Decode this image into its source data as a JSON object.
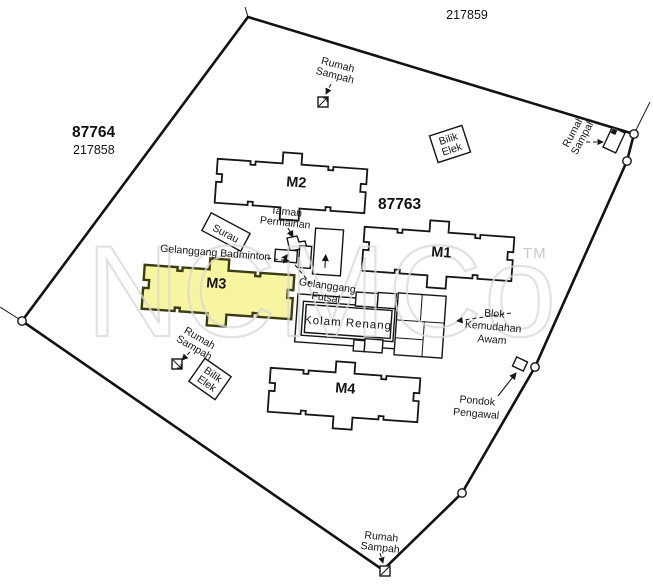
{
  "map": {
    "watermark": {
      "text": "NCMCo",
      "tm": "TM"
    },
    "lots": {
      "top": "217859",
      "left_main": "87764",
      "left_sub": "217858",
      "center": "87763"
    },
    "buildings": {
      "m1": "M1",
      "m2": "M2",
      "m3": "M3",
      "m4": "M4"
    },
    "features": {
      "rumah_sampah": {
        "line1": "Rumah",
        "line2": "Sampah"
      },
      "bilik_elek": {
        "line1": "Bilik",
        "line2": "Elek"
      },
      "surau": {
        "label": "Surau"
      },
      "taman_permainan": {
        "line1": "Taman",
        "line2": "Permainan"
      },
      "gelanggang_badminton": {
        "label": "Gelanggang Badminton"
      },
      "gelanggang_futsal": {
        "line1": "Gelanggang",
        "line2": "Futsal"
      },
      "kolam_renang": {
        "label": "Kolam Renang"
      },
      "blok_kemudahan_awam": {
        "line1": "Blok",
        "line2": "Kemudahan",
        "line3": "Awam"
      },
      "pondok_pengawal": {
        "line1": "Pondok",
        "line2": "Pengawal"
      }
    },
    "colors": {
      "highlight_fill": "#f7f5a0",
      "highlight_stroke": "#3c3c12",
      "ink": "#161616",
      "watermark": "#d7d7d7"
    }
  }
}
